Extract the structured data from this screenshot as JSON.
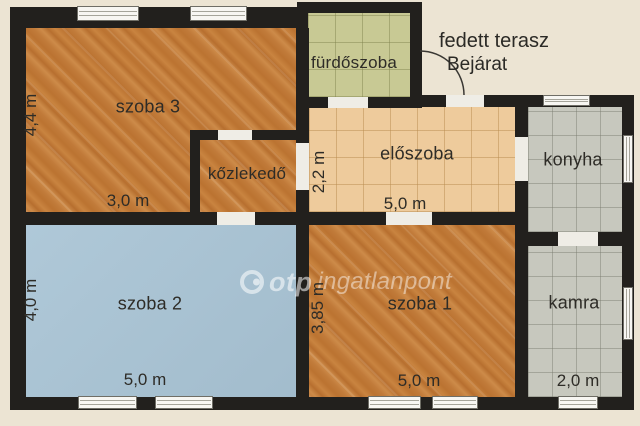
{
  "colors": {
    "background": "#ece4d3",
    "wall": "#22201d",
    "wood_floor": "#c07a3a",
    "blue_floor": "#a9c4d5",
    "bathroom_tile": "#c8c994",
    "hall_tile": "#eecb9c",
    "gray_tile": "#c7c8be",
    "label_text": "#2e2c27",
    "opening_white": "#f7f6f2"
  },
  "terrace": {
    "title": "fedett terasz",
    "entrance": "Bejárat"
  },
  "watermark": {
    "brand": "otp",
    "suffix": "ingatlanpont"
  },
  "rooms": [
    {
      "id": "szoba-3",
      "label": "szoba 3",
      "floor": "wood",
      "x": 26,
      "y": 28,
      "w": 270,
      "h": 184,
      "lx": 148,
      "ly": 107,
      "small": false
    },
    {
      "id": "kozlekedo",
      "label": "kőzlekedő",
      "floor": "wood",
      "x": 200,
      "y": 140,
      "w": 96,
      "h": 72,
      "lx": 247,
      "ly": 174,
      "small": true
    },
    {
      "id": "furdoszoba",
      "label": "fürdőszoba",
      "floor": "greentile",
      "x": 308,
      "y": 13,
      "w": 102,
      "h": 84,
      "lx": 354,
      "ly": 63,
      "small": true
    },
    {
      "id": "eloszoba",
      "label": "előszoba",
      "floor": "tantile",
      "x": 309,
      "y": 107,
      "w": 206,
      "h": 105,
      "lx": 417,
      "ly": 154,
      "small": false
    },
    {
      "id": "konyha",
      "label": "konyha",
      "floor": "graytile",
      "x": 528,
      "y": 107,
      "w": 94,
      "h": 125,
      "lx": 573,
      "ly": 160,
      "small": false
    },
    {
      "id": "szoba-2",
      "label": "szoba 2",
      "floor": "blue",
      "x": 26,
      "y": 225,
      "w": 270,
      "h": 172,
      "lx": 150,
      "ly": 304,
      "small": false
    },
    {
      "id": "szoba-1",
      "label": "szoba 1",
      "floor": "wood",
      "x": 309,
      "y": 225,
      "w": 206,
      "h": 172,
      "lx": 420,
      "ly": 304,
      "small": false
    },
    {
      "id": "kamra",
      "label": "kamra",
      "floor": "graytile",
      "x": 528,
      "y": 246,
      "w": 94,
      "h": 151,
      "lx": 574,
      "ly": 303,
      "small": false
    }
  ],
  "dimensions": [
    {
      "label": "4,4 m",
      "x": 31,
      "y": 115,
      "vertical": true
    },
    {
      "label": "3,0 m",
      "x": 128,
      "y": 201,
      "vertical": false
    },
    {
      "label": "2,2 m",
      "x": 319,
      "y": 172,
      "vertical": true
    },
    {
      "label": "5,0 m",
      "x": 405,
      "y": 204,
      "vertical": false
    },
    {
      "label": "4,0 m",
      "x": 31,
      "y": 300,
      "vertical": true
    },
    {
      "label": "3,85 m",
      "x": 318,
      "y": 308,
      "vertical": true
    },
    {
      "label": "5,0 m",
      "x": 145,
      "y": 380,
      "vertical": false
    },
    {
      "label": "5,0 m",
      "x": 419,
      "y": 381,
      "vertical": false
    },
    {
      "label": "2,0 m",
      "x": 578,
      "y": 381,
      "vertical": false
    }
  ],
  "walls": [
    {
      "id": "top-wall",
      "x": 10,
      "y": 7,
      "w": 298,
      "h": 21
    },
    {
      "id": "left-wall",
      "x": 10,
      "y": 7,
      "w": 16,
      "h": 403
    },
    {
      "id": "bottom-wall",
      "x": 10,
      "y": 397,
      "w": 624,
      "h": 13
    },
    {
      "id": "right-wall",
      "x": 622,
      "y": 95,
      "w": 12,
      "h": 315
    },
    {
      "id": "entrance-wall",
      "x": 410,
      "y": 95,
      "w": 224,
      "h": 12
    },
    {
      "id": "bath-top-wall",
      "x": 297,
      "y": 2,
      "w": 125,
      "h": 11
    },
    {
      "id": "bath-left-wall",
      "x": 297,
      "y": 2,
      "w": 11,
      "h": 105
    },
    {
      "id": "bath-right-wall",
      "x": 410,
      "y": 2,
      "w": 12,
      "h": 105
    },
    {
      "id": "bath-bottom-wall",
      "x": 297,
      "y": 97,
      "w": 125,
      "h": 11
    },
    {
      "id": "center-vertical-wall",
      "x": 296,
      "y": 28,
      "w": 13,
      "h": 369
    },
    {
      "id": "hall-left-wall",
      "x": 190,
      "y": 130,
      "w": 10,
      "h": 95
    },
    {
      "id": "hall-top-wall",
      "x": 190,
      "y": 130,
      "w": 106,
      "h": 10
    },
    {
      "id": "middle-horizontal-wall",
      "x": 10,
      "y": 212,
      "w": 518,
      "h": 13
    },
    {
      "id": "kitchen-left-wall",
      "x": 515,
      "y": 107,
      "w": 13,
      "h": 290
    },
    {
      "id": "kitchen-pantry-wall",
      "x": 528,
      "y": 232,
      "w": 94,
      "h": 14
    }
  ],
  "openings": [
    {
      "id": "szoba3-window-1",
      "kind": "window",
      "dir": "h",
      "x": 77,
      "y": 6,
      "w": 62,
      "h": 15
    },
    {
      "id": "szoba3-window-2",
      "kind": "window",
      "dir": "h",
      "x": 190,
      "y": 6,
      "w": 57,
      "h": 15
    },
    {
      "id": "konyha-top-window",
      "kind": "window",
      "dir": "h",
      "x": 543,
      "y": 95,
      "w": 47,
      "h": 11
    },
    {
      "id": "szoba2-window-1",
      "kind": "window",
      "dir": "h",
      "x": 78,
      "y": 396,
      "w": 59,
      "h": 13
    },
    {
      "id": "szoba2-window-2",
      "kind": "window",
      "dir": "h",
      "x": 155,
      "y": 396,
      "w": 58,
      "h": 13
    },
    {
      "id": "szoba1-window-1",
      "kind": "window",
      "dir": "h",
      "x": 368,
      "y": 396,
      "w": 53,
      "h": 13
    },
    {
      "id": "szoba1-window-2",
      "kind": "window",
      "dir": "h",
      "x": 432,
      "y": 396,
      "w": 46,
      "h": 13
    },
    {
      "id": "kamra-bottom-window",
      "kind": "window",
      "dir": "h",
      "x": 558,
      "y": 396,
      "w": 40,
      "h": 13
    },
    {
      "id": "konyha-right-window",
      "kind": "window",
      "dir": "v",
      "x": 623,
      "y": 135,
      "w": 10,
      "h": 48
    },
    {
      "id": "kamra-right-window",
      "kind": "window",
      "dir": "v",
      "x": 623,
      "y": 287,
      "w": 10,
      "h": 53
    },
    {
      "id": "furdoszoba-door",
      "kind": "door",
      "dir": "h",
      "x": 328,
      "y": 97,
      "w": 40,
      "h": 11
    },
    {
      "id": "entrance-door",
      "kind": "door",
      "dir": "h",
      "x": 446,
      "y": 95,
      "w": 38,
      "h": 12
    },
    {
      "id": "kozlekedo-top-door",
      "kind": "door",
      "dir": "h",
      "x": 218,
      "y": 130,
      "w": 34,
      "h": 10
    },
    {
      "id": "kozlekedo-bottom-door",
      "kind": "door",
      "dir": "h",
      "x": 217,
      "y": 212,
      "w": 38,
      "h": 13
    },
    {
      "id": "kozlekedo-right-door",
      "kind": "door",
      "dir": "v",
      "x": 296,
      "y": 143,
      "w": 13,
      "h": 47
    },
    {
      "id": "eloszoba-konyha-door",
      "kind": "door",
      "dir": "v",
      "x": 515,
      "y": 137,
      "w": 13,
      "h": 44
    },
    {
      "id": "eloszoba-szoba1-door",
      "kind": "door",
      "dir": "h",
      "x": 386,
      "y": 212,
      "w": 46,
      "h": 13
    },
    {
      "id": "konyha-kamra-door",
      "kind": "door",
      "dir": "h",
      "x": 558,
      "y": 232,
      "w": 40,
      "h": 14
    }
  ],
  "entrance_arc": {
    "path": "M 420 51 A 44 44 0 0 1 464 95"
  }
}
